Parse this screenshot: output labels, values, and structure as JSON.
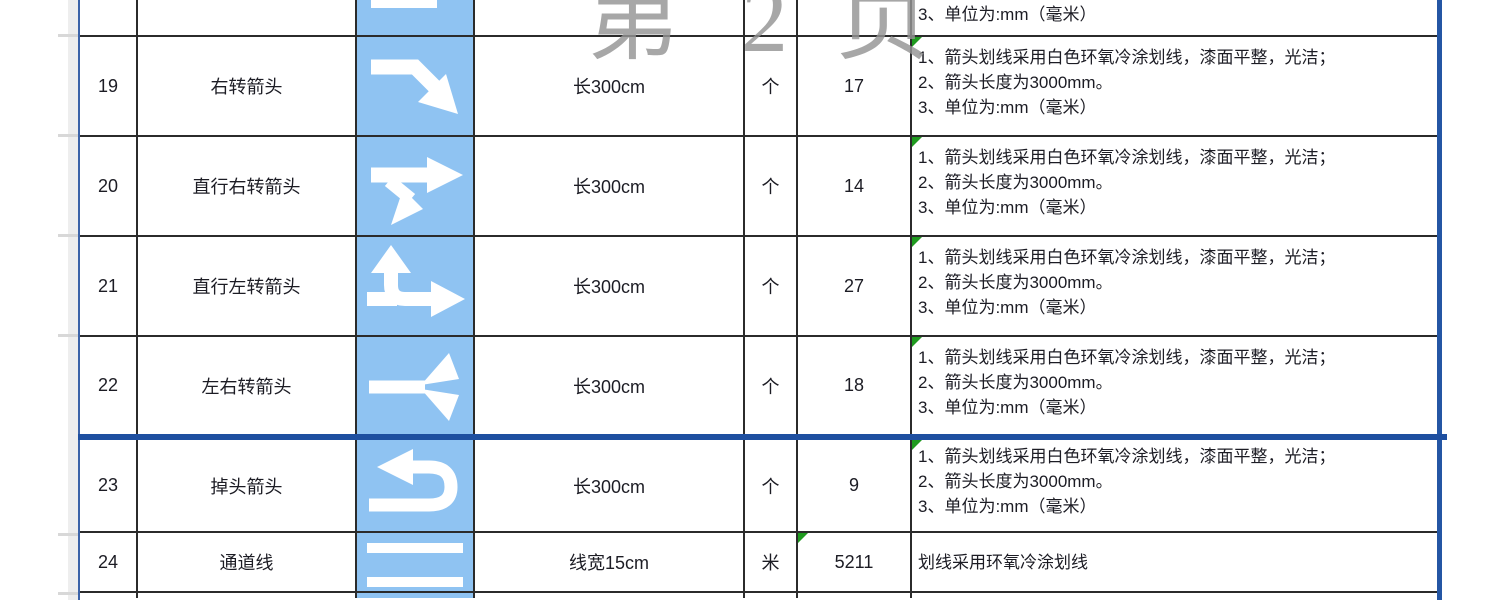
{
  "app": {
    "view": "spreadsheet-page-break-preview",
    "watermark": {
      "c1": "第",
      "c2": "2",
      "c3": "页"
    }
  },
  "colors": {
    "icon_cell_blue": "#8fc3f2",
    "page_break_blue": "#1e4fa0",
    "grid_border_dark": "#2b2b2b",
    "comment_indicator_green": "#1f9a1f",
    "watermark_gray": "#949494"
  },
  "partials": {
    "top_note": "3、单位为:mm（毫米）"
  },
  "rows": [
    {
      "no": "19",
      "name": "右转箭头",
      "icon": "right-turn-arrow",
      "spec": "长300cm",
      "unit": "个",
      "qty": "17",
      "notes": [
        "1、箭头划线采用白色环氧冷涂划线，漆面平整，光洁；",
        "2、箭头长度为3000mm。",
        "3、单位为:mm（毫米）"
      ]
    },
    {
      "no": "20",
      "name": "直行右转箭头",
      "icon": "straight-right-turn-arrow",
      "spec": "长300cm",
      "unit": "个",
      "qty": "14",
      "notes": [
        "1、箭头划线采用白色环氧冷涂划线，漆面平整，光洁；",
        "2、箭头长度为3000mm。",
        "3、单位为:mm（毫米）"
      ]
    },
    {
      "no": "21",
      "name": "直行左转箭头",
      "icon": "straight-left-turn-arrow",
      "spec": "长300cm",
      "unit": "个",
      "qty": "27",
      "notes": [
        "1、箭头划线采用白色环氧冷涂划线，漆面平整，光洁；",
        "2、箭头长度为3000mm。",
        "3、单位为:mm（毫米）"
      ]
    },
    {
      "no": "22",
      "name": "左右转箭头",
      "icon": "left-right-turn-arrow",
      "spec": "长300cm",
      "unit": "个",
      "qty": "18",
      "notes": [
        "1、箭头划线采用白色环氧冷涂划线，漆面平整，光洁；",
        "2、箭头长度为3000mm。",
        "3、单位为:mm（毫米）"
      ]
    },
    {
      "no": "23",
      "name": "掉头箭头",
      "icon": "u-turn-arrow",
      "spec": "长300cm",
      "unit": "个",
      "qty": "9",
      "notes": [
        "1、箭头划线采用白色环氧冷涂划线，漆面平整，光洁；",
        "2、箭头长度为3000mm。",
        "3、单位为:mm（毫米）"
      ]
    },
    {
      "no": "24",
      "name": "通道线",
      "icon": "channel-lines",
      "spec": "线宽15cm",
      "unit": "米",
      "qty": "5211",
      "notes": [
        "划线采用环氧冷涂划线"
      ]
    }
  ]
}
